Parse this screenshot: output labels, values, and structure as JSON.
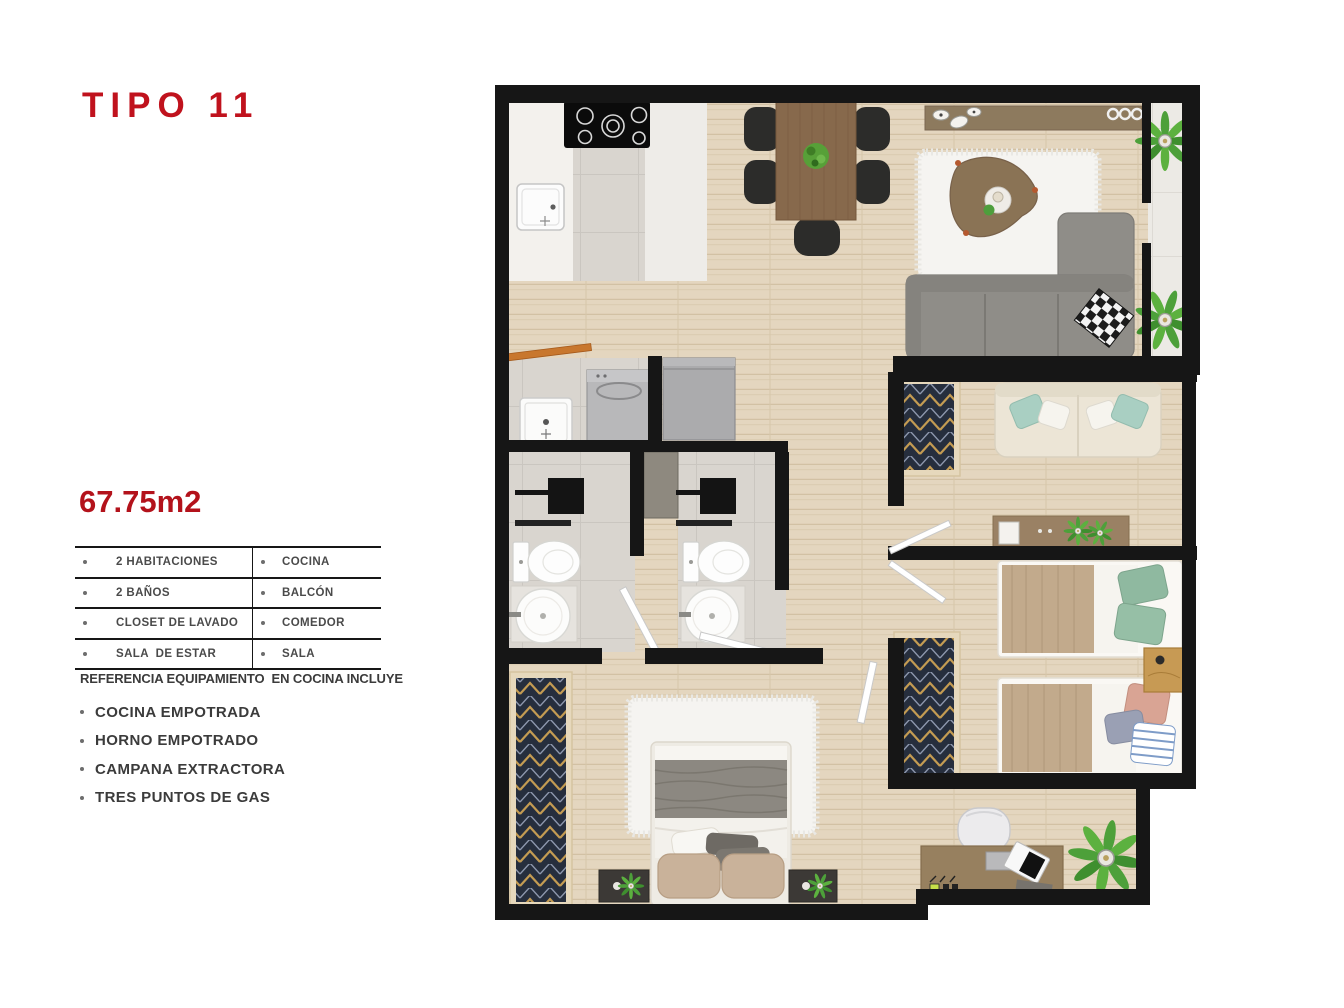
{
  "title": "TIPO 11",
  "area": "67.75m2",
  "features_table": {
    "rows": [
      {
        "left": "2 HABITACIONES",
        "right": "COCINA"
      },
      {
        "left": "2 BAÑOS",
        "right": "BALCÓN"
      },
      {
        "left": "CLOSET DE LAVADO",
        "right": "COMEDOR"
      },
      {
        "left": "SALA  DE ESTAR",
        "right": "SALA"
      }
    ]
  },
  "reference_heading": "REFERENCIA EQUIPAMIENTO  EN COCINA INCLUYE",
  "reference_items": [
    "COCINA EMPOTRADA",
    "HORNO EMPOTRADO",
    "CAMPANA EXTRACTORA",
    "TRES PUNTOS DE GAS"
  ],
  "floorplan": {
    "rooms": [
      "cocina",
      "comedor",
      "sala",
      "balcon",
      "closet-de-lavado",
      "bano-1",
      "bano-2",
      "sala-de-estar",
      "habitacion-principal",
      "habitacion-2",
      "zona-estudio"
    ]
  },
  "colors": {
    "accent_red": "#c0121d",
    "wall_black": "#161616",
    "wood_floor": "#e4d6bf",
    "tile_gray": "#d9d5cf",
    "sofa_gray": "#8f8d88",
    "rug_white": "#f5f4f1",
    "wood_furniture": "#87694c",
    "plant_green": "#4da03a",
    "closet_navy": "#262e3d",
    "pillow_teal": "#a9cfc2",
    "pillow_green": "#8fb9a0",
    "blanket_tan": "#c2aa8c"
  }
}
